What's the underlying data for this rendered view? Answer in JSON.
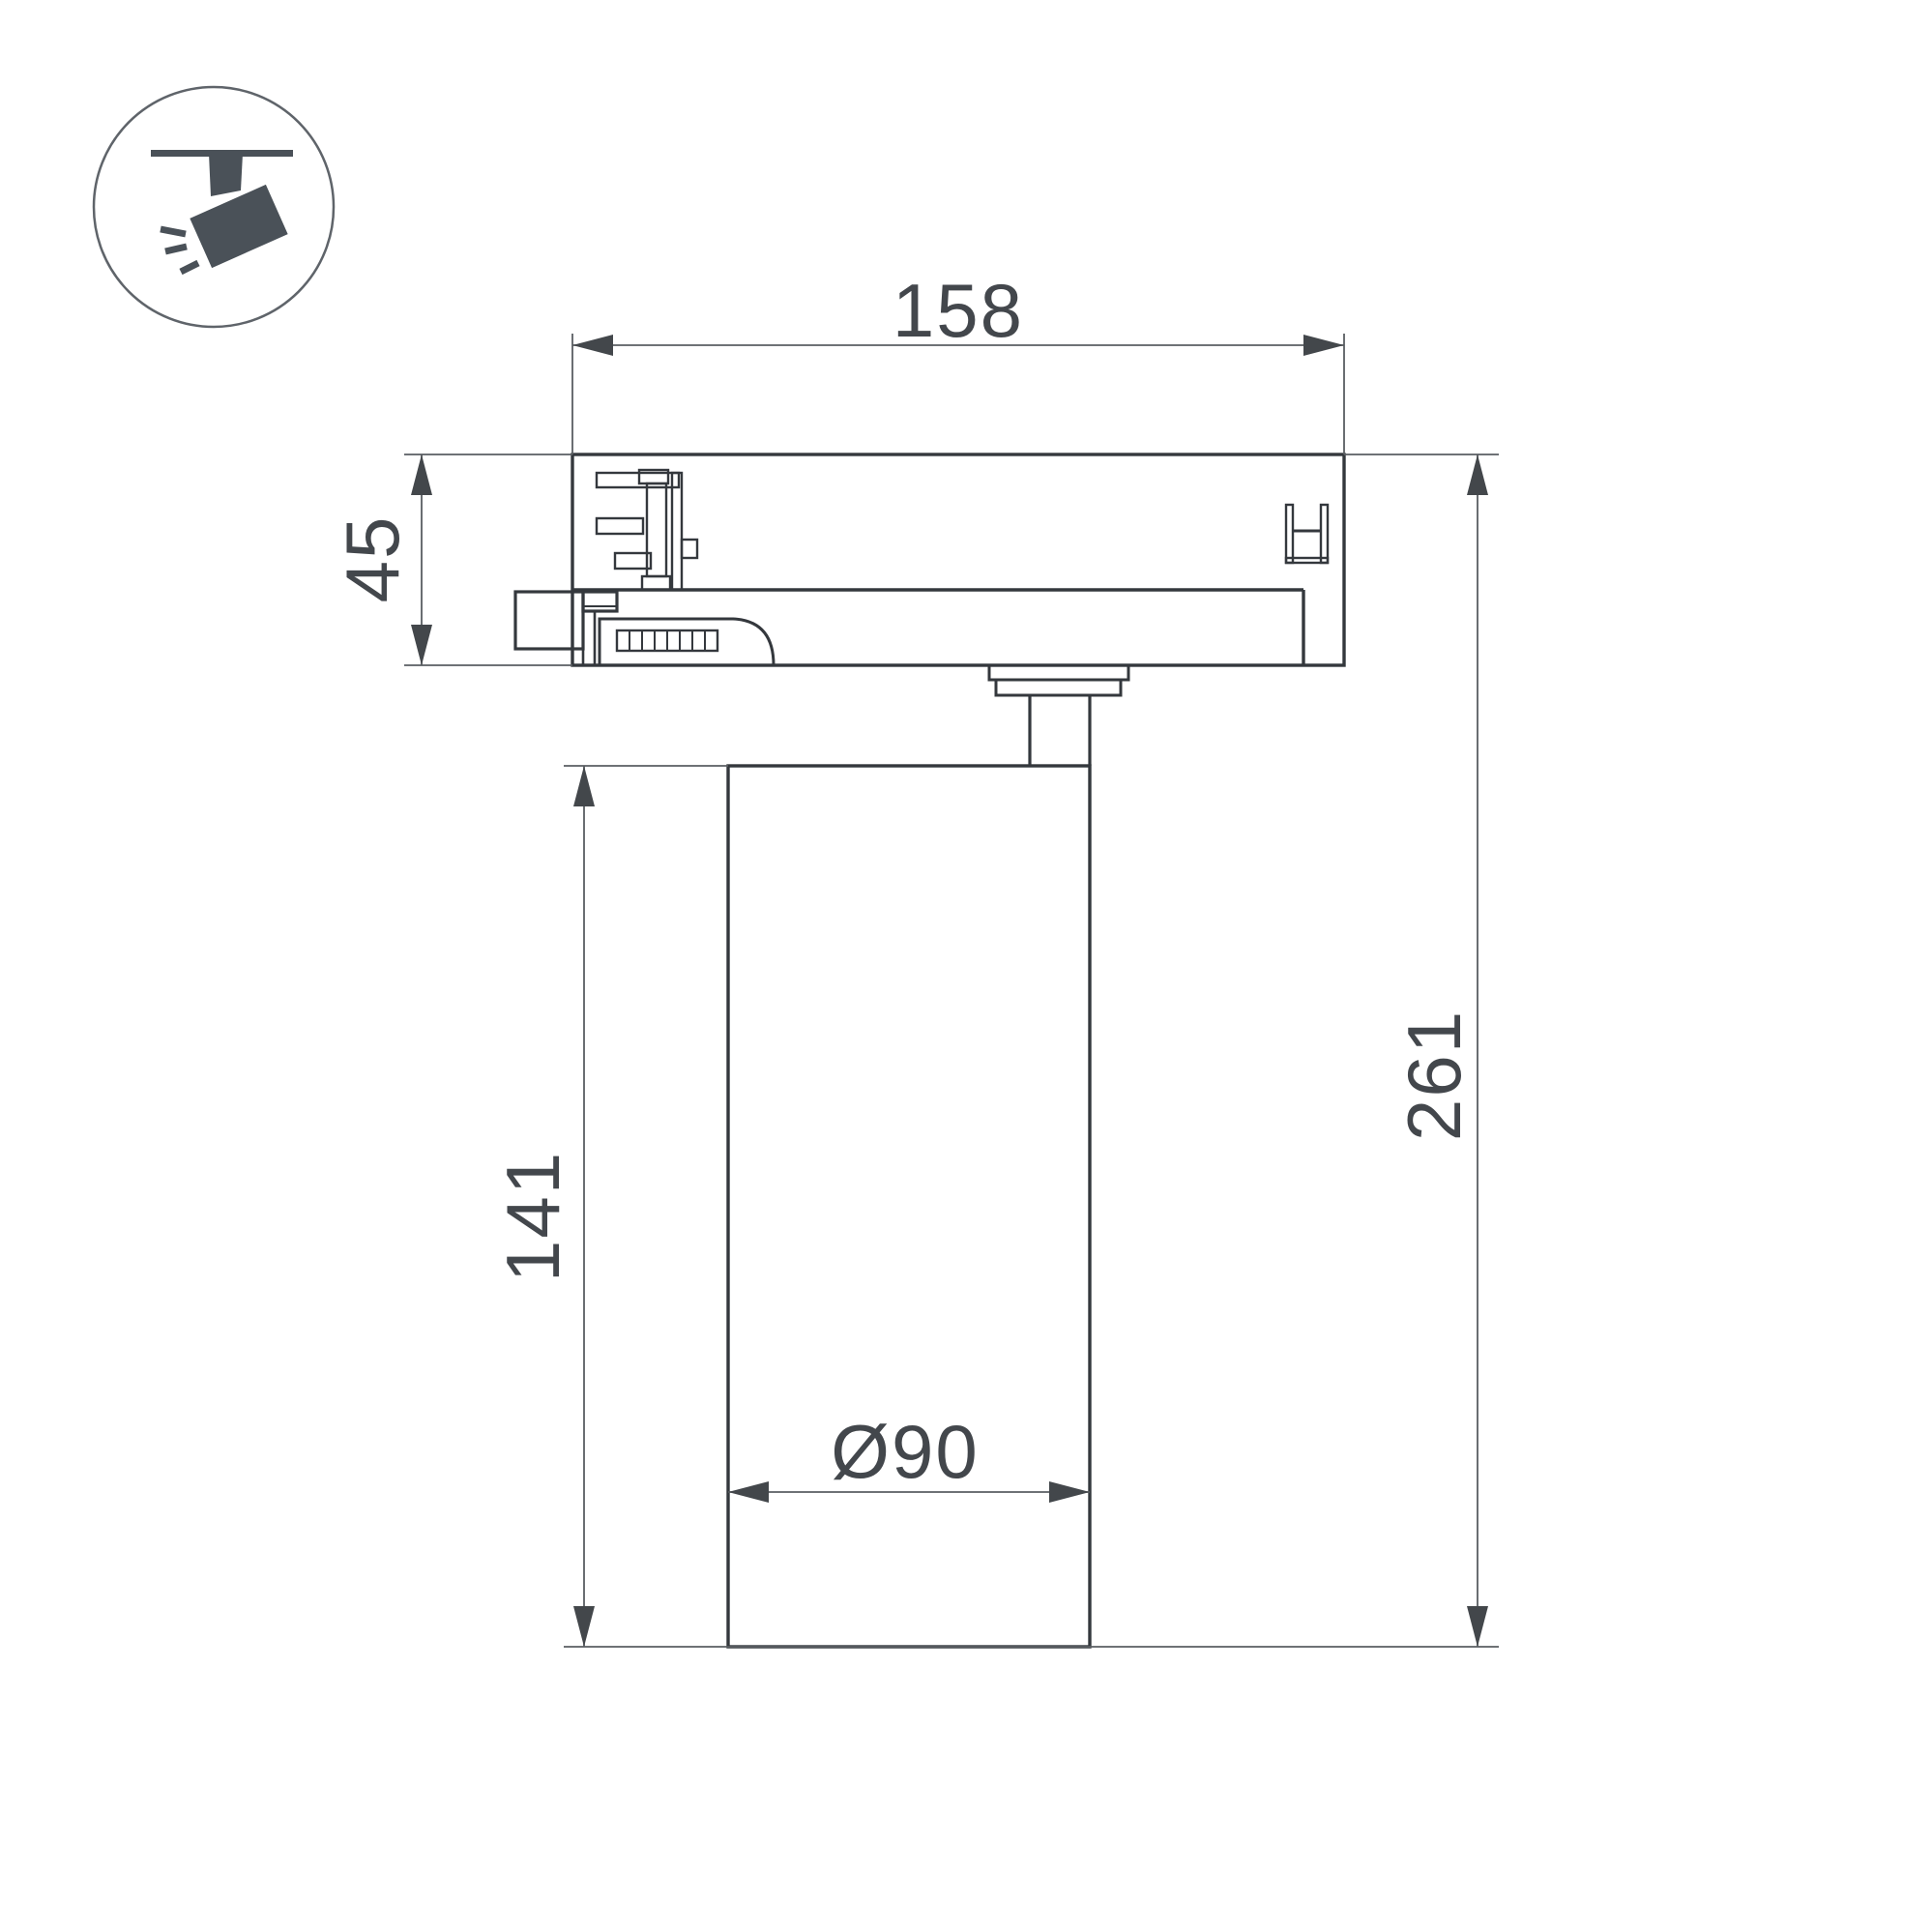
{
  "title": "track-spotlight-dimension-drawing",
  "icon": {
    "name": "track-spotlight-pictogram",
    "color": "#4a5158",
    "circle_stroke": "#5f646a"
  },
  "dimensions": {
    "track_adapter_width": "158",
    "track_adapter_height": "45",
    "body_height": "141",
    "total_height": "261",
    "body_diameter": "Ø90"
  },
  "colors": {
    "outline": "#34383d",
    "dimension_lines": "#5a5e62",
    "dimension_text": "#43474c",
    "background": "#ffffff"
  }
}
